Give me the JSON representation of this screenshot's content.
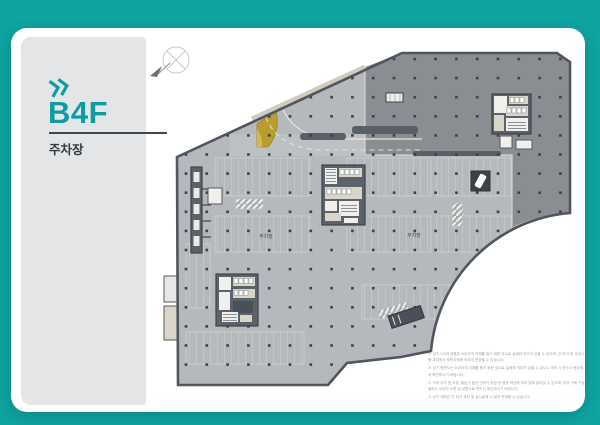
{
  "page": {
    "background_color": "#0fa3a1",
    "card_color": "#ffffff",
    "panel_color": "#e4e5e7"
  },
  "sidebar": {
    "floor_label": "B4F",
    "category_label": "주차장",
    "accent_color": "#0d9ca1"
  },
  "plan": {
    "area_labels": [
      "주차장",
      "주차장"
    ],
    "zone_colors": {
      "parking_floor": "#b5b8bc",
      "drive_zone": "#8a8e93",
      "ramp_yellow": "#b99d2e",
      "wall": "#50565d"
    }
  },
  "notes": [
    "※ 상기 CG와 내용은 소비자의 이해를 돕기 위한 것으로 실제와 차이가 있을 수 있으며, 인·허가 및 사업시행 과정에서 제반사정에 의하여 변경될 수 있습니다.",
    "※ 상기 평면도는 소비자의 이해를 돕기 위한 것으로 실제와 차이가 있을 수 있으니 계약 시 반드시 현장에서 확인하시기 바랍니다.",
    "※ 지하 주차 및 조경, 출입구 등은 인허가 과정 및 현장 여건에 따라 일부 달라질 수 있으며, 주차 구획 기능 배치는 소비자 노면 및 성향으로 반드시 확인하시기 바랍니다.",
    "※ 상기 계획은 인·허가 과정 및 실시설계 시 일부 변경될 수 있습니다."
  ]
}
